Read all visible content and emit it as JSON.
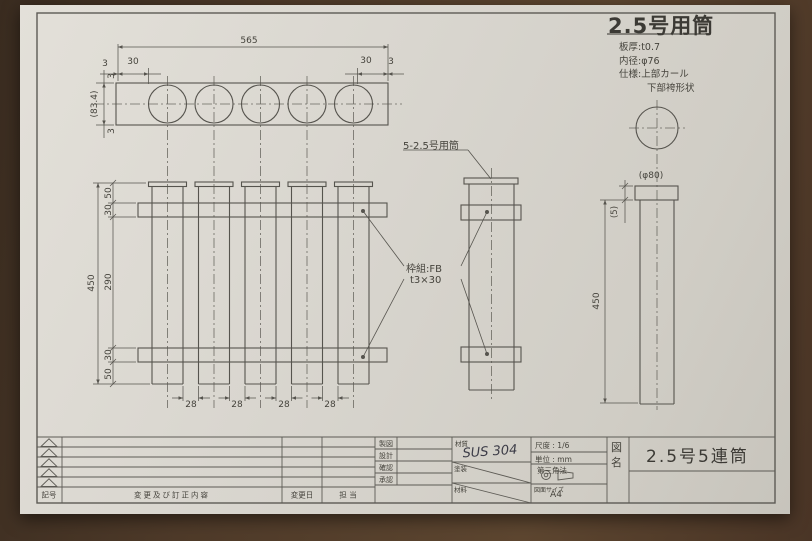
{
  "header": {
    "title": "2.5号用筒",
    "spec_thickness": "板厚:t0.7",
    "spec_inner_dia": "内径:φ76",
    "spec_top": "仕様:上部カール",
    "spec_bottom": "下部袴形状"
  },
  "top_view": {
    "dim_overall": "565",
    "dim_margin_l": "3",
    "dim_pitch_l": "30",
    "dim_pitch_r": "30",
    "dim_margin_r": "3",
    "dim_depth_t": "3",
    "dim_depth": "(83.4)",
    "dim_depth_b": "3"
  },
  "front_view": {
    "dim_overall": "450",
    "dim_top": "50",
    "dim_bar_t": "30",
    "dim_mid": "290",
    "dim_bar_b": "30",
    "dim_bot": "50",
    "dim_gaps": [
      "28",
      "28",
      "28",
      "28"
    ]
  },
  "callouts": {
    "tubes": "5-2.5号用筒",
    "frame_l1": "枠組:FB",
    "frame_l2": "t3×30"
  },
  "part_view": {
    "dim_dia": "(φ80)",
    "dim_cap": "(5)",
    "dim_height": "450"
  },
  "title_block": {
    "sign_labels": [
      "製図",
      "設計",
      "確認",
      "承認"
    ],
    "material_label": "材質",
    "material_value": "SUS 304",
    "coating_label": "塗装",
    "stock_label": "材料",
    "scale": "尺度 : 1/6",
    "unit": "単位 : mm",
    "projection": "第三角法",
    "size_label": "図面サイズ",
    "size_value": "A4",
    "name_label": "図名",
    "drawing_name": "2.5号5連筒"
  },
  "revision": {
    "col_symbol": "記号",
    "col_content": "変更及び訂正内容",
    "col_date": "変更日",
    "col_person": "担 当"
  }
}
